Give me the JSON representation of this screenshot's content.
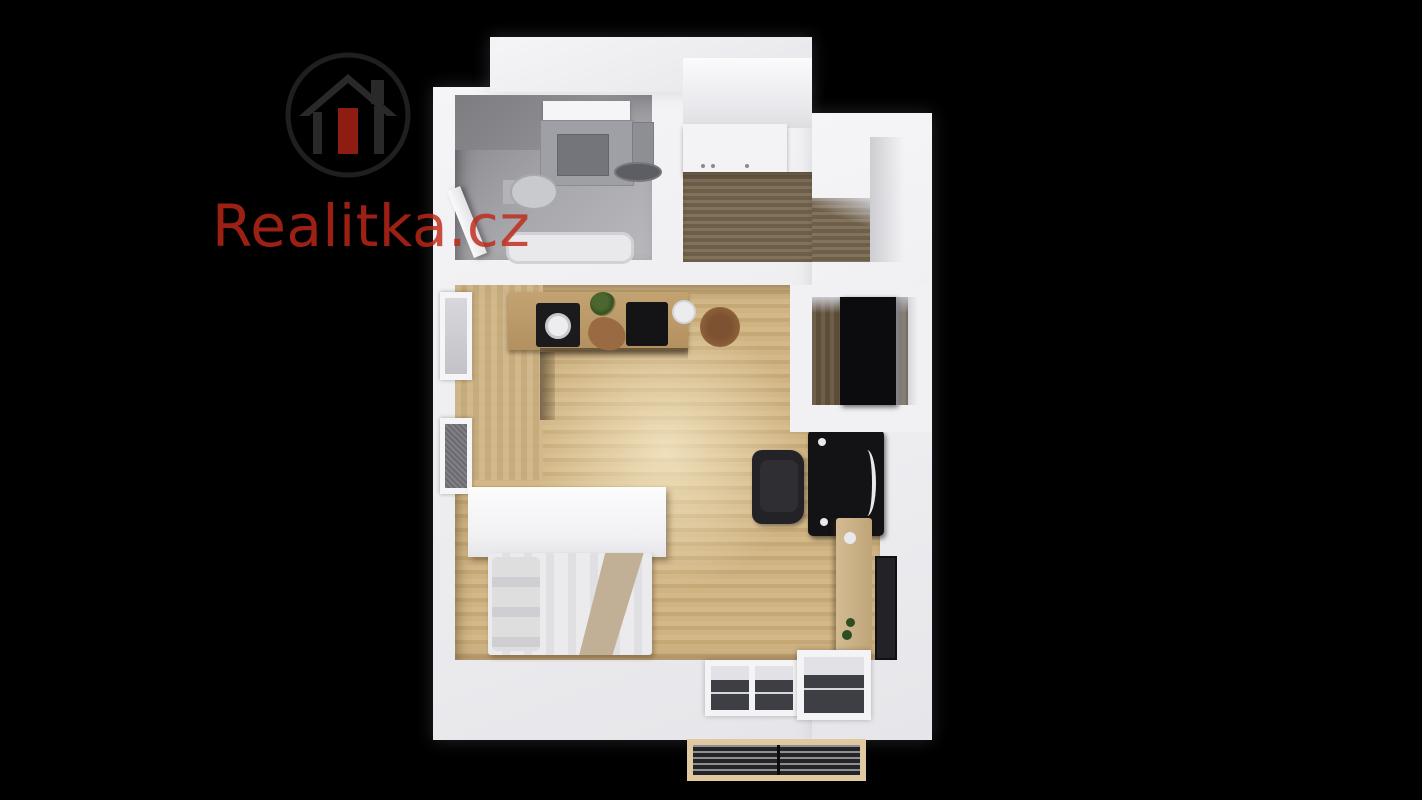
{
  "watermark": {
    "brand_text": "Realitka.cz",
    "logo_icon": "house-in-circle"
  },
  "palette": {
    "background": "#000000",
    "wall": "#f1f1f4",
    "brand_red": "rgba(190,40,24,0.82)",
    "logo_ring": "#1f1f1f",
    "logo_house": "#292929",
    "logo_door": "#8e1c10",
    "hall_wood_dark": "#6e5f4a",
    "hall_wood_light": "#83735c",
    "blanket_tan": "#c2b096",
    "balcony_frame": "#e0c9a1",
    "balcony_deck_dark": "#242427",
    "balcony_deck_light": "#8f8f94"
  },
  "rooms": [
    {
      "name": "bathroom"
    },
    {
      "name": "entry-hall"
    },
    {
      "name": "wardrobe-room"
    },
    {
      "name": "living-room-with-kitchen"
    },
    {
      "name": "sleeping-area"
    },
    {
      "name": "balcony"
    }
  ]
}
